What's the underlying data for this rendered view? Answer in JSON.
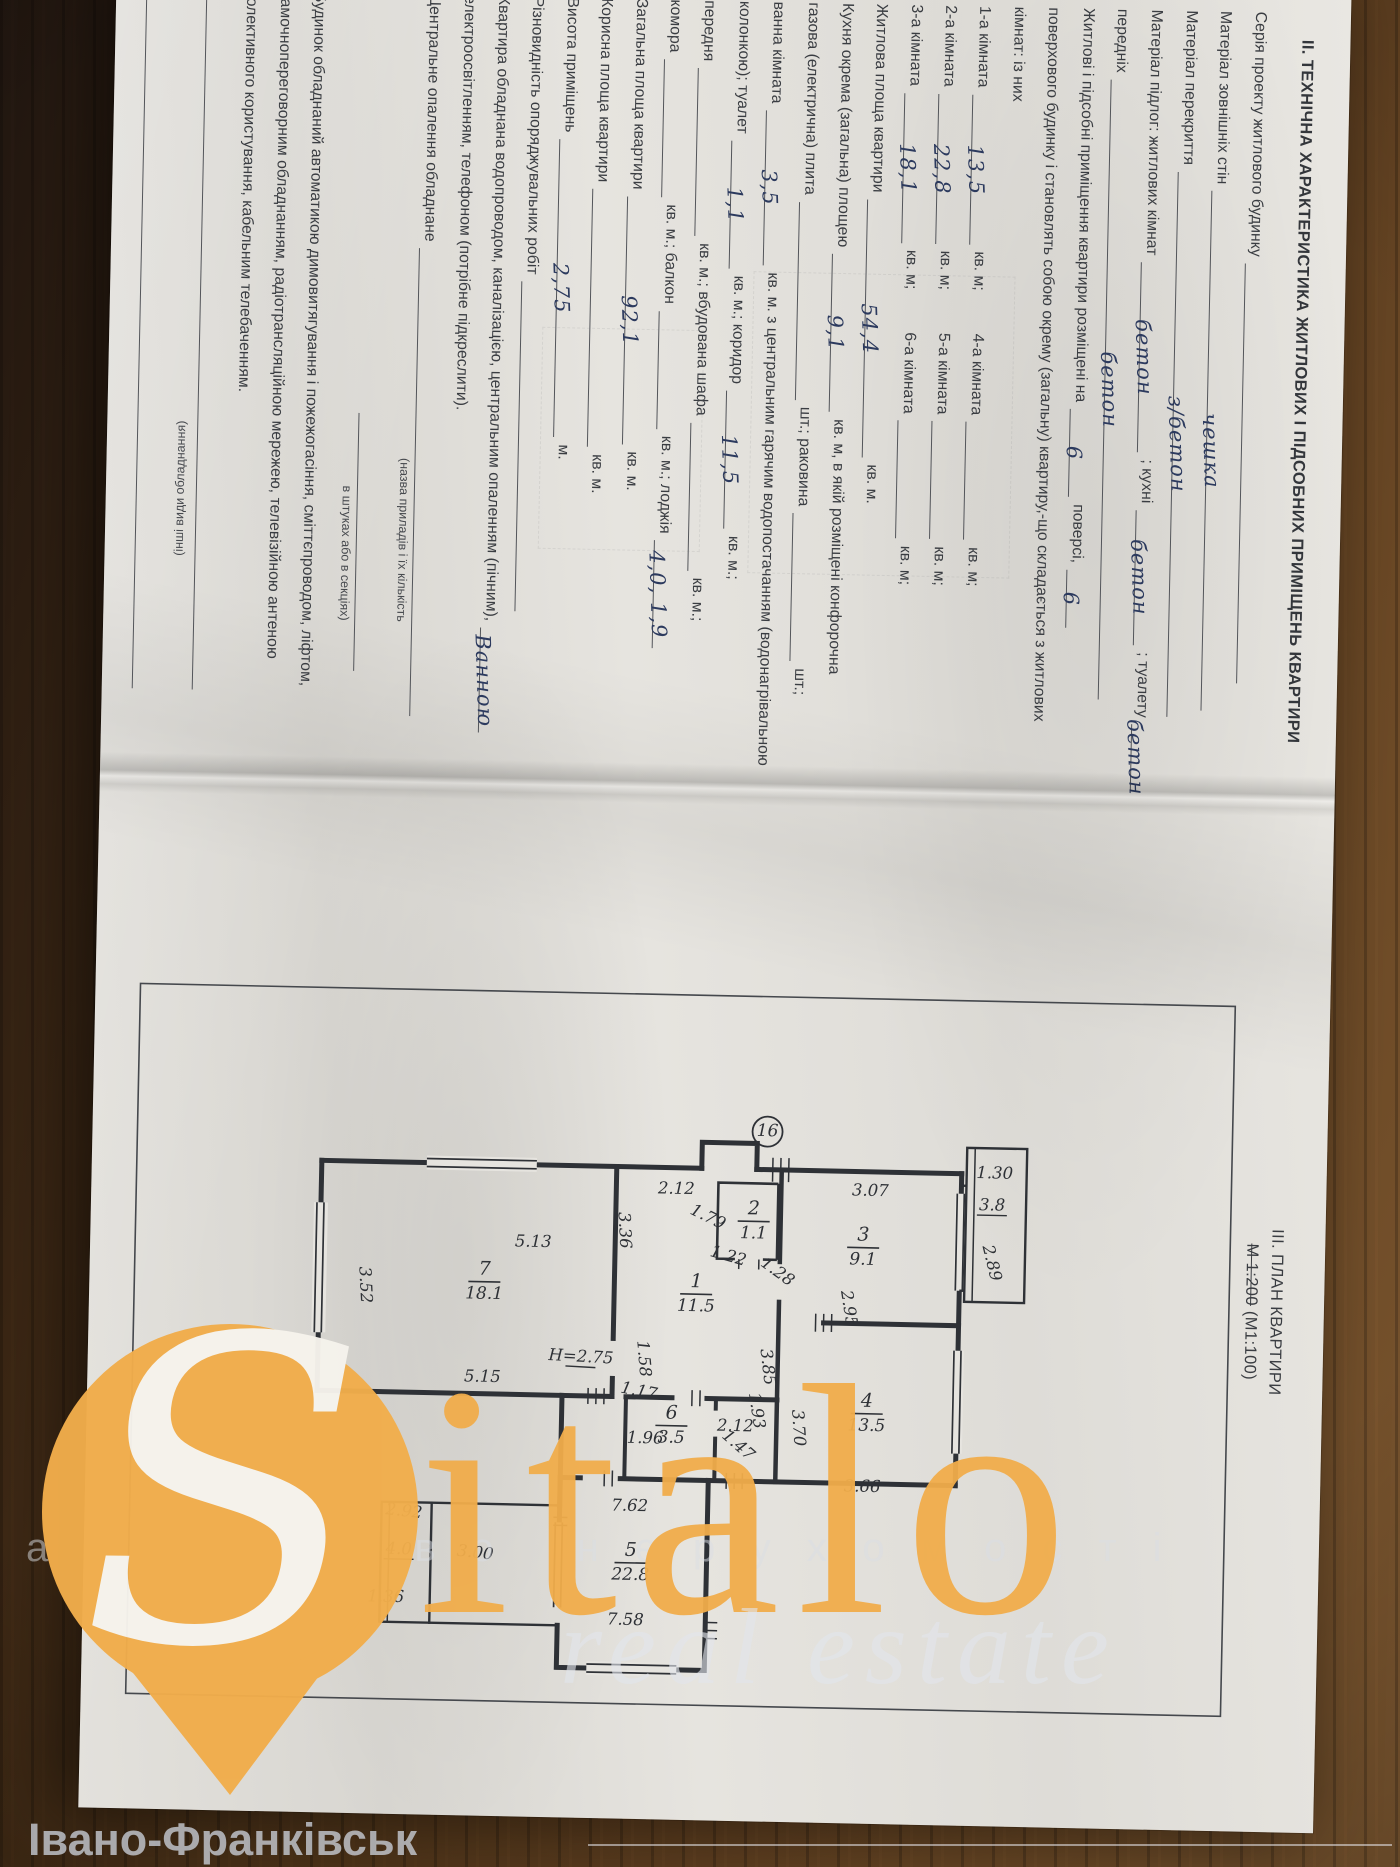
{
  "doc": {
    "section2_title": "ІІ. ТЕХНІЧНА ХАРАКТЕРИСТИКА ЖИТЛОВИХ І ПІДСОБНИХ ПРИМІЩЕНЬ КВАРТИРИ",
    "section3_title": "ІІІ. ПЛАН КВАРТИРИ",
    "scale_struck": "М 1:200",
    "scale_rest": "(М1:100)"
  },
  "form": {
    "lines": [
      {
        "seg": [
          {
            "t": "Серія проекту житлового будинку"
          },
          {
            "r": 420,
            "v": ""
          }
        ]
      },
      {
        "seg": [
          {
            "t": "Матеріал зовнішніх стін"
          },
          {
            "r": 520,
            "v": "чешка"
          }
        ]
      },
      {
        "seg": [
          {
            "t": "Матеріал перекриття"
          },
          {
            "r": 545,
            "v": "з/бетон"
          }
        ]
      },
      {
        "seg": [
          {
            "t": "Матеріал підлог: житлових кімнат"
          },
          {
            "r": 190,
            "v": "бетон"
          },
          {
            "t": "; кухні"
          },
          {
            "r": 135,
            "v": "бетон"
          },
          {
            "t": "; туалету"
          },
          {
            "r": 66,
            "v": "бетон"
          }
        ]
      },
      {
        "seg": [
          {
            "t": "передніх"
          },
          {
            "r": 620,
            "v": "бетон"
          }
        ]
      },
      {
        "seg": [
          {
            "t": "Житлові і підсобні приміщення квартири розміщені на"
          },
          {
            "r": 88,
            "v": "6"
          },
          {
            "t": "поверсі,"
          },
          {
            "r": 58,
            "v": "6"
          }
        ]
      },
      {
        "seg": [
          {
            "t": "поверхового будинку і становлять собою окрему (загальну) квартиру,-що складається з житлових"
          }
        ]
      },
      {
        "seg": [
          {
            "t": "кімнат: із них"
          }
        ]
      },
      {
        "seg": [
          {
            "t": "1-а кімната"
          },
          {
            "r": 150,
            "v": "13,5"
          },
          {
            "t": "кв. м;"
          },
          {
            "g": 38
          },
          {
            "t": "4-а кімната"
          },
          {
            "r": 118,
            "v": ""
          },
          {
            "t": "кв. м;"
          }
        ]
      },
      {
        "seg": [
          {
            "t": "2-а кімната"
          },
          {
            "r": 150,
            "v": "22,8"
          },
          {
            "t": "кв. м;"
          },
          {
            "g": 38
          },
          {
            "t": "5-а кімната"
          },
          {
            "r": 118,
            "v": ""
          },
          {
            "t": "кв. м;"
          }
        ]
      },
      {
        "seg": [
          {
            "t": "3-а кімната"
          },
          {
            "r": 150,
            "v": "18,1"
          },
          {
            "t": "кв. м;"
          },
          {
            "g": 38
          },
          {
            "t": "6-а кімната"
          },
          {
            "r": 118,
            "v": ""
          },
          {
            "t": "кв. м;"
          }
        ]
      },
      {
        "seg": [
          {
            "t": "Житлова площа квартири"
          },
          {
            "r": 258,
            "v": "54,4"
          },
          {
            "t": "кв. м."
          }
        ]
      },
      {
        "seg": [
          {
            "t": "Кухня окрема (загальна) площею"
          },
          {
            "r": 158,
            "v": "9,1"
          },
          {
            "t": "кв. м, в якій розміщені конфорочна"
          }
        ]
      },
      {
        "seg": [
          {
            "t": "газова (електрична) плита"
          },
          {
            "r": 198,
            "v": ""
          },
          {
            "t": "шт.; раковина"
          },
          {
            "r": 148,
            "v": ""
          },
          {
            "t": "шт.;"
          }
        ]
      },
      {
        "seg": [
          {
            "t": "ванна кімната"
          },
          {
            "r": 155,
            "v": "3,5"
          },
          {
            "t": "кв. м. з центральним гарячим водопостачанням (водонагрівальною"
          }
        ]
      },
      {
        "seg": [
          {
            "t": "колонкою); туалет"
          },
          {
            "r": 128,
            "v": "1,1"
          },
          {
            "t": "кв. м.; коридор"
          },
          {
            "r": 138,
            "v": "11,5"
          },
          {
            "t": "кв. м.;"
          }
        ]
      },
      {
        "seg": [
          {
            "t": "передня"
          },
          {
            "r": 168,
            "v": ""
          },
          {
            "t": "кв. м.; вбудована шафа"
          },
          {
            "r": 148,
            "v": ""
          },
          {
            "t": "кв. м.;"
          }
        ]
      },
      {
        "seg": [
          {
            "t": "комора"
          },
          {
            "r": 138,
            "v": ""
          },
          {
            "t": "кв. м.; балкон"
          },
          {
            "r": 118,
            "v": ""
          },
          {
            "t": "кв. м.; лоджія"
          },
          {
            "r": 108,
            "v": "4,0, 1,9"
          }
        ]
      },
      {
        "seg": [
          {
            "t": "Загальна площа квартири"
          },
          {
            "r": 248,
            "v": "92,1"
          },
          {
            "t": "кв. м."
          }
        ]
      },
      {
        "seg": [
          {
            "t": "Корисна площа квартири"
          },
          {
            "r": 258,
            "v": ""
          },
          {
            "t": "кв. м."
          }
        ]
      },
      {
        "seg": [
          {
            "t": "Висота приміщень"
          },
          {
            "r": 298,
            "v": "2,75"
          },
          {
            "t": "м."
          }
        ]
      },
      {
        "seg": [
          {
            "t": "Різновидність опоряджувальних робіт"
          },
          {
            "r": 330,
            "v": ""
          }
        ]
      },
      {
        "seg": [
          {
            "t": "Квартира обладнана водопроводом, каналізацією, центральним опаленням (пічним),"
          },
          {
            "r": 105,
            "v": "Ванною"
          }
        ]
      },
      {
        "seg": [
          {
            "t": "електроосвітленням, телефоном (потрібне підкреслити)."
          }
        ]
      },
      {
        "seg": [
          {
            "t": "Центральне опалення обладнане"
          },
          {
            "r": 468,
            "v": ""
          }
        ]
      },
      {
        "cap": "(назва приладів і їх кількість",
        "align": "right"
      },
      {
        "seg": [
          {
            "g": 420
          },
          {
            "r": 258,
            "v": ""
          }
        ]
      },
      {
        "cap": "в штуках або в секціях)",
        "align": "right"
      },
      {
        "seg": [
          {
            "t": "Будинок обладнаний автоматикою димовитягування і пожежогасіння, сміттєпроводом, ліфтом,"
          }
        ]
      },
      {
        "seg": [
          {
            "t": "замочнопереговорним обладнанням, радіотрансляційною мережею, телевізійною антеною"
          }
        ]
      },
      {
        "seg": [
          {
            "t": "колективного користування, кабельним телебаченням."
          }
        ]
      },
      {
        "seg": [
          {
            "r": 700,
            "v": ""
          }
        ]
      },
      {
        "cap": "(інші види обладнання)",
        "flip": true
      },
      {
        "seg": [
          {
            "r": 700,
            "v": ""
          }
        ]
      }
    ]
  },
  "plan": {
    "chimney_label": "16",
    "rooms": [
      {
        "n": "1",
        "area": "11.5",
        "x": 514,
        "y": 628
      },
      {
        "n": "2",
        "area": "1.1",
        "x": 440,
        "y": 572
      },
      {
        "n": "3",
        "area": "9.1",
        "x": 464,
        "y": 462
      },
      {
        "n": "4",
        "area": "13.5",
        "x": 630,
        "y": 455
      },
      {
        "n": "5",
        "area": "22.8",
        "x": 784,
        "y": 688
      },
      {
        "n": "6",
        "area": "3.5",
        "x": 646,
        "y": 650
      },
      {
        "n": "7",
        "area": "18.1",
        "x": 506,
        "y": 840
      }
    ],
    "dims": [
      {
        "t": "2.12",
        "x": 414,
        "y": 650,
        "r": -90
      },
      {
        "t": "3.36",
        "x": 452,
        "y": 706,
        "r": -4
      },
      {
        "t": "1.79",
        "x": 441,
        "y": 620,
        "r": -65
      },
      {
        "t": "1.22",
        "x": 480,
        "y": 598,
        "r": -75
      },
      {
        "t": "1.28",
        "x": 494,
        "y": 550,
        "r": -55
      },
      {
        "t": "3.07",
        "x": 412,
        "y": 456,
        "r": -90
      },
      {
        "t": "2.95",
        "x": 526,
        "y": 480,
        "r": -10
      },
      {
        "t": "1.30",
        "x": 392,
        "y": 332,
        "r": -90
      },
      {
        "t": "3.8",
        "x": 424,
        "y": 334,
        "r": -90,
        "u": 1
      },
      {
        "t": "2.89",
        "x": 478,
        "y": 338,
        "r": -15
      },
      {
        "t": "1.58",
        "x": 580,
        "y": 684,
        "r": -6
      },
      {
        "t": "2.12",
        "x": 650,
        "y": 586,
        "r": -90
      },
      {
        "t": "3.85",
        "x": 586,
        "y": 560,
        "r": -8
      },
      {
        "t": "3.70",
        "x": 646,
        "y": 528,
        "r": -5
      },
      {
        "t": "3.66",
        "x": 708,
        "y": 458,
        "r": -90
      },
      {
        "t": "1.17",
        "x": 617,
        "y": 684,
        "r": -80
      },
      {
        "t": "1.96",
        "x": 664,
        "y": 676,
        "r": -90
      },
      {
        "t": "1.93",
        "x": 630,
        "y": 570,
        "r": -10
      },
      {
        "t": "1.47",
        "x": 668,
        "y": 586,
        "r": -50
      },
      {
        "t": "H=2.75",
        "x": 584,
        "y": 742,
        "r": -88,
        "u": 1
      },
      {
        "t": "5.13",
        "x": 470,
        "y": 792,
        "r": -90
      },
      {
        "t": "3.52",
        "x": 512,
        "y": 964,
        "r": -4
      },
      {
        "t": "5.15",
        "x": 606,
        "y": 840,
        "r": -90
      },
      {
        "t": "7.62",
        "x": 732,
        "y": 690,
        "r": -90
      },
      {
        "t": "7.58",
        "x": 846,
        "y": 692,
        "r": -90
      },
      {
        "t": "3.00",
        "x": 782,
        "y": 844,
        "r": -85
      },
      {
        "t": "2.92",
        "x": 742,
        "y": 916,
        "r": -85
      },
      {
        "t": "4.0",
        "x": 780,
        "y": 920,
        "r": -90,
        "u": 1
      },
      {
        "t": "1.36",
        "x": 828,
        "y": 932,
        "r": -90
      }
    ]
  },
  "watermark": {
    "logo_s": "S",
    "logo_rest": "italo",
    "tagline": "real estate",
    "agency_line": "агентство нерухомості",
    "city": "Івано-Франківськ",
    "accent_color": "#F1AD4B"
  },
  "colors": {
    "paper": "#e6e4df",
    "wood": "#5f3f20",
    "print_ink": "#3a3d42",
    "handwriting_ink": "#2c3a5e",
    "plan_ink": "#2e3136"
  }
}
